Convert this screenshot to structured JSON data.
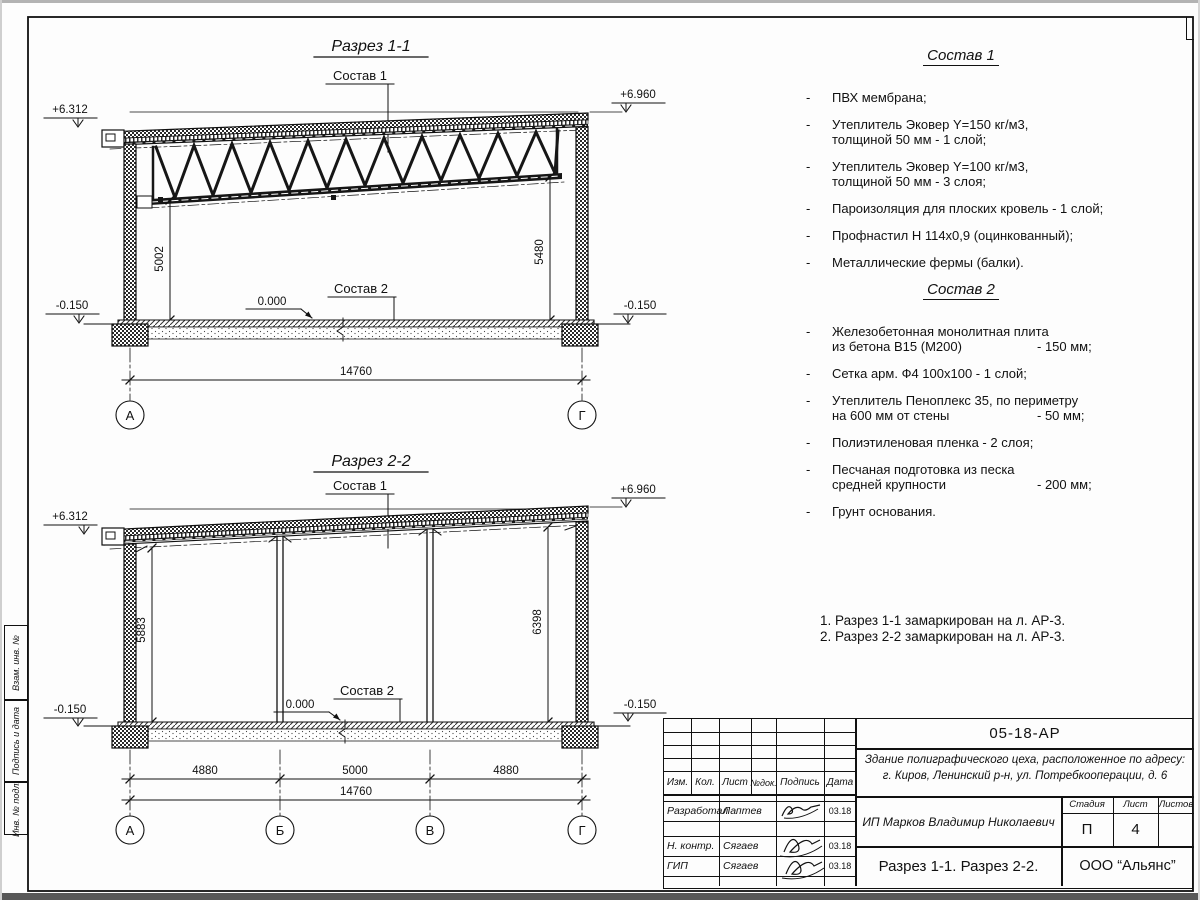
{
  "section1": {
    "title": "Разрез 1-1",
    "label_roof": "Состав 1",
    "label_floor": "Состав 2",
    "elev_left": "+6.312",
    "elev_right": "+6.960",
    "elev_zero": "0.000",
    "elev_base_left": "-0.150",
    "elev_base_right": "-0.150",
    "dim_left": "5002",
    "dim_right": "5480",
    "dim_total": "14760",
    "axis_left": "А",
    "axis_right": "Г"
  },
  "section2": {
    "title": "Разрез 2-2",
    "label_roof": "Состав 1",
    "label_floor": "Состав 2",
    "elev_left": "+6.312",
    "elev_right": "+6.960",
    "elev_zero": "0.000",
    "elev_base_left": "-0.150",
    "elev_base_right": "-0.150",
    "dim_left": "5883",
    "dim_right": "6398",
    "span1": "4880",
    "span2": "5000",
    "span3": "4880",
    "dim_total": "14760",
    "axis1": "А",
    "axis2": "Б",
    "axis3": "В",
    "axis4": "Г"
  },
  "sostav1": {
    "title": "Состав 1",
    "items": [
      {
        "l1": "ПВХ мембрана;"
      },
      {
        "l1": "Утеплитель Эковер Y=150 кг/м3,",
        "l2": "толщиной 50 мм - 1 слой;"
      },
      {
        "l1": "Утеплитель Эковер Y=100 кг/м3,",
        "l2": "толщиной 50 мм - 3 слоя;"
      },
      {
        "l1": "Пароизоляция для плоских кровель - 1 слой;"
      },
      {
        "l1": "Профнастил Н 114х0,9 (оцинкованный);"
      },
      {
        "l1": "Металлические фермы (балки)."
      }
    ]
  },
  "sostav2": {
    "title": "Состав 2",
    "items": [
      {
        "l1": "Железобетонная  монолитная плита",
        "l2": "из бетона В15 (М200)",
        "v": "- 150 мм;"
      },
      {
        "l1": "Сетка арм. Ф4 100х100 - 1 слой;"
      },
      {
        "l1": "Утеплитель Пеноплекс 35, по периметру",
        "l2": "на 600 мм от стены",
        "v": "- 50 мм;"
      },
      {
        "l1": "Полиэтиленовая пленка - 2 слоя;"
      },
      {
        "l1": "Песчаная подготовка из песка",
        "l2": "средней крупности",
        "v": "- 200 мм;"
      },
      {
        "l1": "Грунт основания."
      }
    ]
  },
  "notes": {
    "n1": "1. Разрез 1-1 замаркирован на л. АР-3.",
    "n2": "2. Разрез 2-2 замаркирован на л. АР-3."
  },
  "titleblock": {
    "doc_number": "05-18-АР",
    "object_line1": "Здание полиграфического цеха, расположенное по адресу:",
    "object_line2": "г. Киров,  Ленинский р-н, ул. Потребкооперации, д. 6",
    "client": "ИП Марков Владимир Николаевич",
    "sheet_title": "Разрез 1-1. Разрез 2-2.",
    "company": "ООО “Альянс”",
    "stage_label": "Стадия",
    "sheet_label": "Лист",
    "sheets_label": "Листов",
    "stage": "П",
    "sheet": "4",
    "sheets": "",
    "cols": [
      "Изм.",
      "Кол.",
      "Лист",
      "№док.",
      "Подпись",
      "Дата"
    ],
    "rows": [
      {
        "role": "Разработал",
        "name": "Лаптев",
        "date": "03.18"
      },
      {
        "role": "Н. контр.",
        "name": "Сягаев",
        "date": "03.18"
      },
      {
        "role": "ГИП",
        "name": "Сягаев",
        "date": "03.18"
      }
    ]
  },
  "side_stamp": {
    "labels": [
      "Взам. инв. №",
      "Подпись и дата",
      "Инв. № подл."
    ]
  }
}
